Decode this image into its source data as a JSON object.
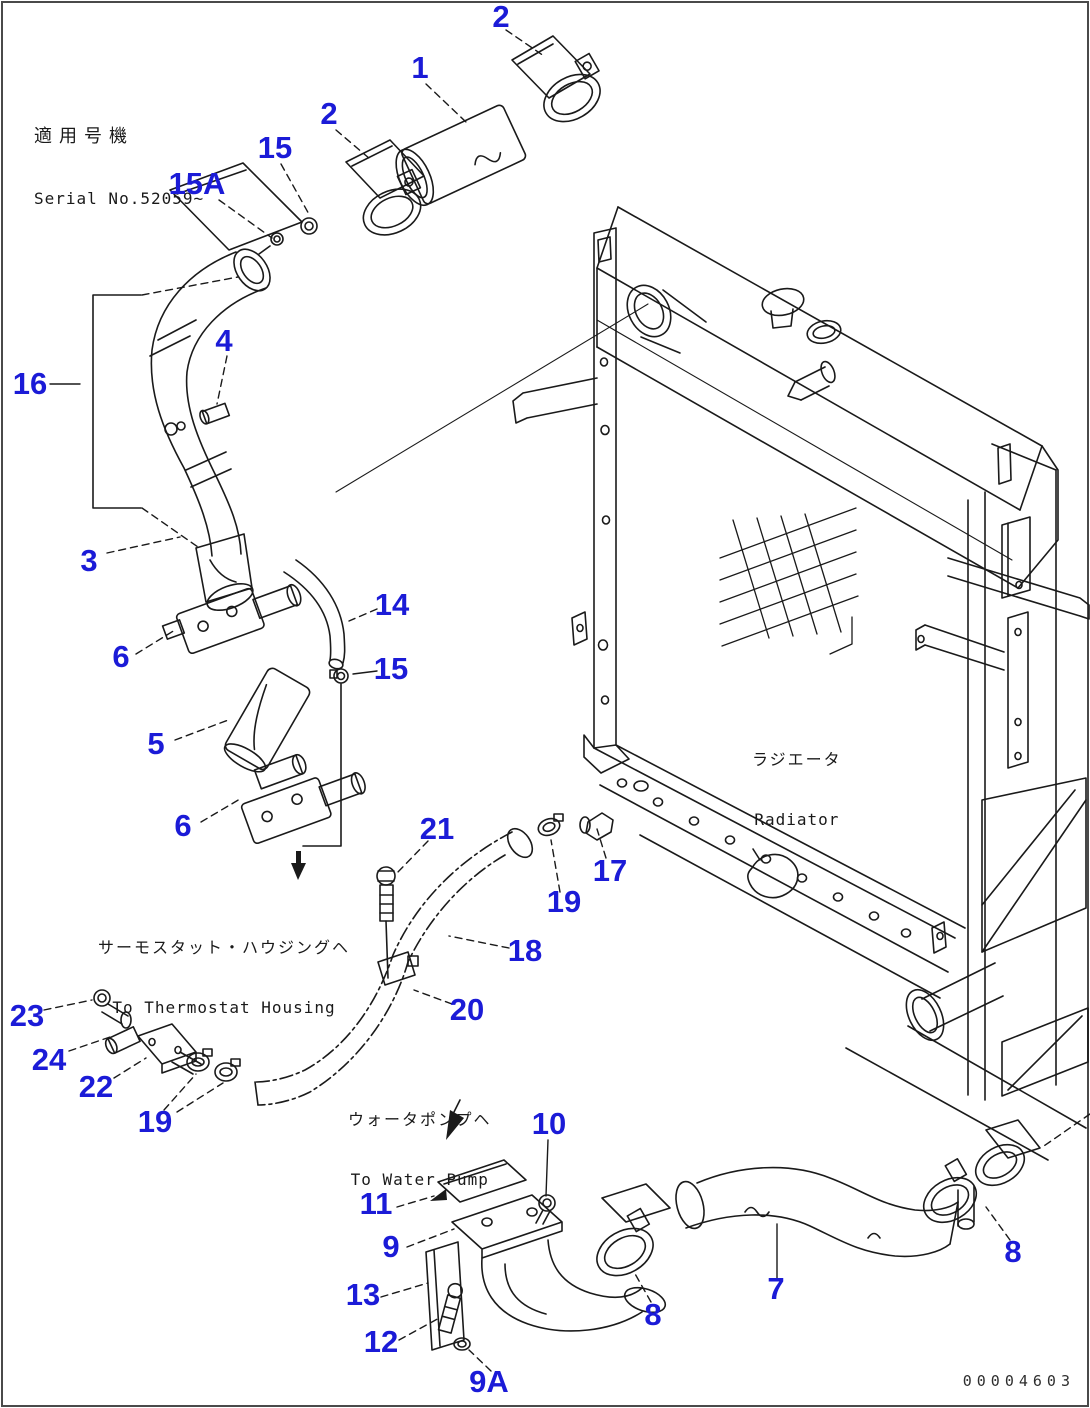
{
  "header": {
    "applicable_machine_jp": "適用号機",
    "serial_no": "Serial No.52059~"
  },
  "radiator": {
    "label_jp": "ラジエータ",
    "label_en": "Radiator"
  },
  "annotations": {
    "thermostat_jp": "サーモスタット・ハウジングヘ",
    "thermostat_en": "To Thermostat Housing",
    "water_pump_jp": "ウォータポンプヘ",
    "water_pump_en": "To Water Pump"
  },
  "footer": {
    "drawing_number": "00004603"
  },
  "colors": {
    "callout_blue": "#1b1bd7",
    "line_black": "#1a1a1a",
    "background": "#ffffff",
    "border_gray": "#4a4a4a"
  },
  "callouts": [
    {
      "label": "2",
      "x": 501,
      "y": 17
    },
    {
      "label": "1",
      "x": 420,
      "y": 68
    },
    {
      "label": "2",
      "x": 329,
      "y": 114
    },
    {
      "label": "15",
      "x": 275,
      "y": 148
    },
    {
      "label": "15A",
      "x": 197,
      "y": 184
    },
    {
      "label": "16",
      "x": 30,
      "y": 384
    },
    {
      "label": "4",
      "x": 224,
      "y": 341
    },
    {
      "label": "3",
      "x": 89,
      "y": 561
    },
    {
      "label": "14",
      "x": 392,
      "y": 605
    },
    {
      "label": "6",
      "x": 121,
      "y": 657
    },
    {
      "label": "15",
      "x": 391,
      "y": 669
    },
    {
      "label": "5",
      "x": 156,
      "y": 744
    },
    {
      "label": "6",
      "x": 183,
      "y": 826
    },
    {
      "label": "21",
      "x": 437,
      "y": 829
    },
    {
      "label": "17",
      "x": 610,
      "y": 871
    },
    {
      "label": "19",
      "x": 564,
      "y": 902
    },
    {
      "label": "18",
      "x": 525,
      "y": 951
    },
    {
      "label": "20",
      "x": 467,
      "y": 1010
    },
    {
      "label": "23",
      "x": 27,
      "y": 1016
    },
    {
      "label": "24",
      "x": 49,
      "y": 1060
    },
    {
      "label": "22",
      "x": 96,
      "y": 1087
    },
    {
      "label": "19",
      "x": 155,
      "y": 1122
    },
    {
      "label": "10",
      "x": 549,
      "y": 1124
    },
    {
      "label": "11",
      "x": 376,
      "y": 1204
    },
    {
      "label": "9",
      "x": 391,
      "y": 1247
    },
    {
      "label": "13",
      "x": 363,
      "y": 1295
    },
    {
      "label": "12",
      "x": 381,
      "y": 1342
    },
    {
      "label": "9A",
      "x": 489,
      "y": 1382
    },
    {
      "label": "8",
      "x": 653,
      "y": 1315
    },
    {
      "label": "7",
      "x": 776,
      "y": 1289
    },
    {
      "label": "8",
      "x": 1013,
      "y": 1252
    }
  ]
}
